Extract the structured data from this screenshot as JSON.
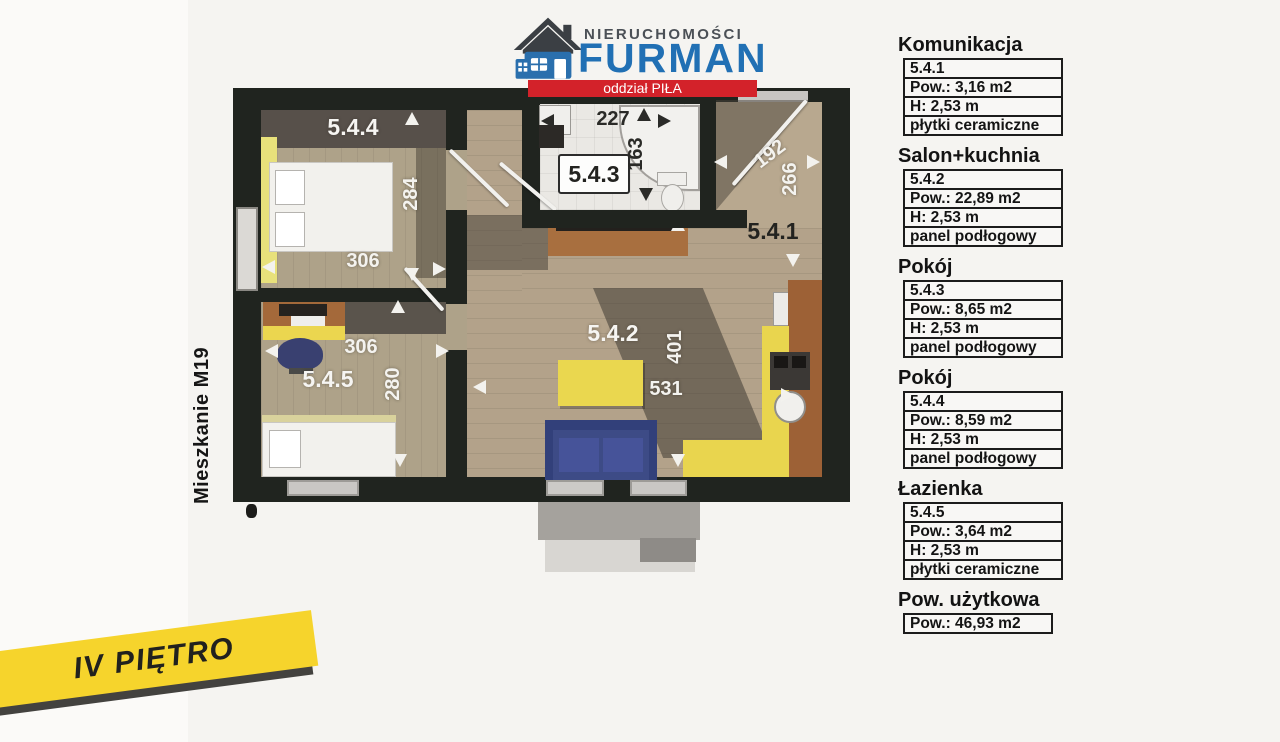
{
  "logo": {
    "brand_top": "NIERUCHOMOŚCI",
    "brand_name": "FURMAN",
    "branch_label": "oddział PIŁA",
    "brand_blue": "#2170b4",
    "banner_red": "#d3222a"
  },
  "plan": {
    "apartment_label": "Mieszkanie M19",
    "floor_label": "IV PIĘTRO",
    "rooms": {
      "r544": {
        "label": "5.4.4",
        "dim_v": "284",
        "dim_h": "306"
      },
      "r543": {
        "label": "5.4.3",
        "dim_h": "227",
        "dim_v": "163"
      },
      "r541": {
        "label": "5.4.1",
        "dim_h": "192",
        "dim_v": "266"
      },
      "r542": {
        "label": "5.4.2",
        "dim_v": "401",
        "dim_h": "531"
      },
      "r545": {
        "label": "5.4.5",
        "dim_h": "306",
        "dim_v": "280"
      }
    }
  },
  "legend": {
    "sections": [
      {
        "title": "Komunikacja",
        "rows": [
          "5.4.1",
          "Pow.: 3,16 m2",
          "H: 2,53 m",
          "płytki ceramiczne"
        ]
      },
      {
        "title": "Salon+kuchnia",
        "rows": [
          "5.4.2",
          "Pow.: 22,89 m2",
          "H: 2,53 m",
          "panel podłogowy"
        ]
      },
      {
        "title": "Pokój",
        "rows": [
          "5.4.3",
          "Pow.: 8,65 m2",
          "H: 2,53 m",
          "panel podłogowy"
        ]
      },
      {
        "title": "Pokój",
        "rows": [
          "5.4.4",
          "Pow.: 8,59 m2",
          "H: 2,53 m",
          "panel podłogowy"
        ]
      },
      {
        "title": "Łazienka",
        "rows": [
          "5.4.5",
          "Pow.: 3,64 m2",
          "H: 2,53 m",
          "płytki ceramiczne"
        ]
      },
      {
        "title": "Pow. użytkowa",
        "rows": [
          "Pow.: 46,93 m2"
        ]
      }
    ]
  }
}
